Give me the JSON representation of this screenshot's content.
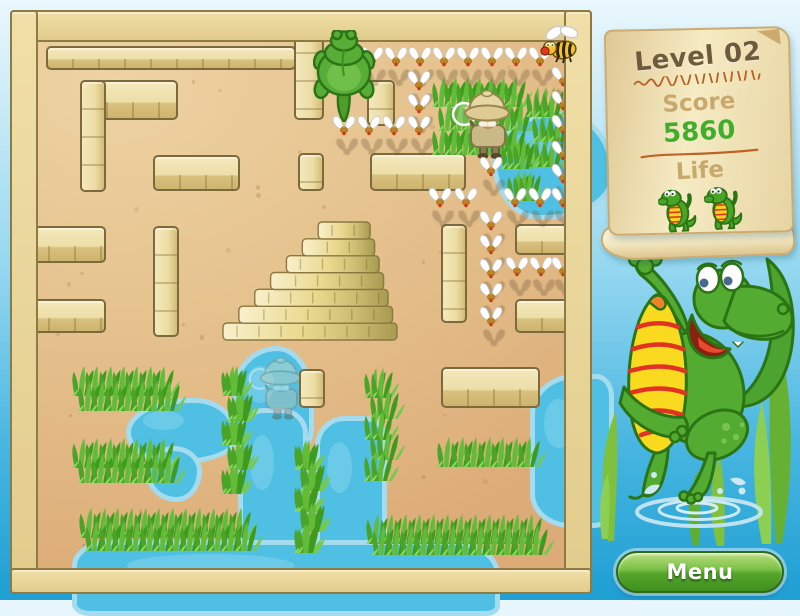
{
  "hud": {
    "level": "Level 02",
    "score_label": "Score",
    "score_value": "5860",
    "life_label": "Life",
    "lives": 2
  },
  "menu": {
    "label": "Menu"
  },
  "colors": {
    "score_value": "#3fae2c",
    "scroll_label": "#c8a96d",
    "title_text": "#6e5b3c",
    "sand": "#e5c18d",
    "wall": "#eddfa8",
    "water": "#4fc0e4",
    "grass": "#5cb832",
    "frame": "#e9d596",
    "menu_green": "#55a52b",
    "sky_top": "#eaf7fd",
    "sky_bottom": "#1f9fd3"
  },
  "board": {
    "walls": [
      [
        36,
        36,
        250,
        24
      ],
      [
        70,
        70,
        98,
        40
      ],
      [
        70,
        70,
        26,
        112
      ],
      [
        284,
        14,
        30,
        96
      ],
      [
        357,
        70,
        28,
        46
      ],
      [
        143,
        145,
        87,
        36
      ],
      [
        288,
        143,
        26,
        38
      ],
      [
        360,
        143,
        96,
        38
      ],
      [
        12,
        216,
        84,
        37
      ],
      [
        143,
        216,
        26,
        111
      ],
      [
        431,
        214,
        26,
        99
      ],
      [
        505,
        214,
        62,
        31
      ],
      [
        12,
        289,
        84,
        34
      ],
      [
        505,
        289,
        62,
        34
      ],
      [
        289,
        359,
        26,
        39
      ],
      [
        431,
        357,
        99,
        41
      ]
    ],
    "pyramid": {
      "x": 213,
      "y": 212,
      "w": 174,
      "h": 118
    },
    "ponds": [
      {
        "x": 482,
        "y": 102,
        "w": 112,
        "h": 98,
        "r": "55% 45% 60% 42% / 48% 58% 42% 58%"
      },
      {
        "x": 116,
        "y": 388,
        "w": 102,
        "h": 56,
        "r": "60% 40% 55% 45% / 55% 60% 40% 50%"
      },
      {
        "x": 136,
        "y": 436,
        "w": 46,
        "h": 46,
        "r": "50% 50% 45% 55% / 50% 45% 55% 50%"
      },
      {
        "x": 222,
        "y": 336,
        "w": 72,
        "h": 108,
        "r": "55% 45% 48% 52% / 40% 45% 30% 35%"
      },
      {
        "x": 228,
        "y": 398,
        "w": 60,
        "h": 160,
        "r": "26px"
      },
      {
        "x": 305,
        "y": 406,
        "w": 62,
        "h": 150,
        "r": "30px 22px 10px 26px"
      },
      {
        "x": 62,
        "y": 530,
        "w": 418,
        "h": 66,
        "r": "36px 50px 14px 18px / 26px 34px 10px 12px"
      },
      {
        "x": 520,
        "y": 364,
        "w": 74,
        "h": 144,
        "r": "45px 18px 20px 40px / 40px 22px 18px 34px"
      }
    ],
    "grass": [
      [
        63,
        353,
        106,
        49
      ],
      [
        63,
        425,
        106,
        49
      ],
      [
        70,
        495,
        176,
        47
      ],
      [
        212,
        353,
        30,
        132
      ],
      [
        285,
        427,
        29,
        117
      ],
      [
        355,
        355,
        33,
        117
      ],
      [
        357,
        501,
        180,
        45
      ],
      [
        428,
        424,
        107,
        44
      ],
      [
        423,
        64,
        98,
        82
      ],
      [
        517,
        74,
        42,
        84
      ],
      [
        492,
        126,
        38,
        66
      ]
    ],
    "flies": [
      [
        362,
        46
      ],
      [
        386,
        46
      ],
      [
        410,
        46
      ],
      [
        434,
        46
      ],
      [
        458,
        46
      ],
      [
        482,
        46
      ],
      [
        506,
        46
      ],
      [
        530,
        46
      ],
      [
        409,
        70
      ],
      [
        409,
        93
      ],
      [
        409,
        115
      ],
      [
        334,
        115
      ],
      [
        359,
        115
      ],
      [
        384,
        115
      ],
      [
        553,
        66
      ],
      [
        553,
        90
      ],
      [
        553,
        114
      ],
      [
        553,
        140
      ],
      [
        553,
        163
      ],
      [
        553,
        187
      ],
      [
        430,
        187
      ],
      [
        456,
        187
      ],
      [
        505,
        187
      ],
      [
        530,
        187
      ],
      [
        481,
        156
      ],
      [
        481,
        210
      ],
      [
        481,
        234
      ],
      [
        481,
        258
      ],
      [
        481,
        282
      ],
      [
        481,
        306
      ],
      [
        507,
        256
      ],
      [
        531,
        256
      ],
      [
        553,
        256
      ]
    ],
    "characters": {
      "player": {
        "x": 303,
        "y": 20
      },
      "explorer": {
        "x": 441,
        "y": 76
      },
      "ghost": {
        "x": 238,
        "y": 342
      },
      "bee": {
        "x": 529,
        "y": 14
      }
    }
  }
}
